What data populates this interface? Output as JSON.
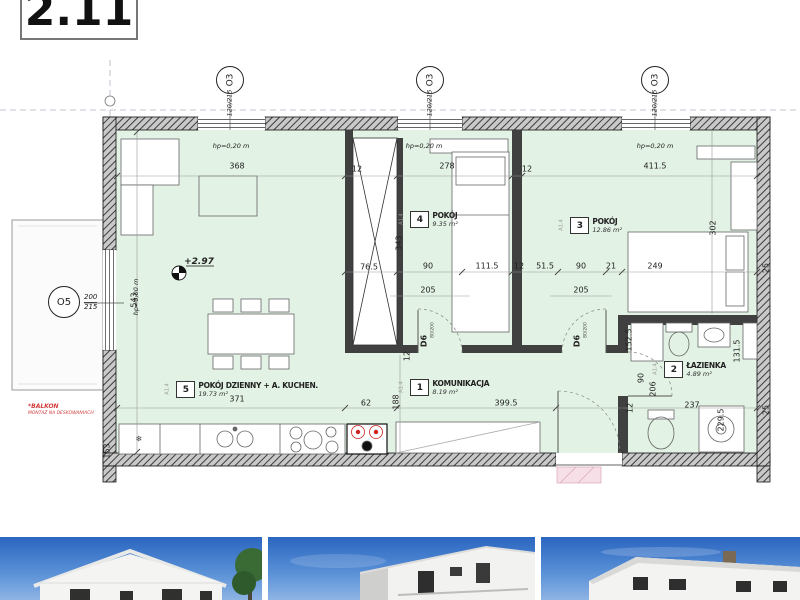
{
  "title_block": {
    "unit_number": "2.11"
  },
  "markers": {
    "top": [
      {
        "label": "O3",
        "size": "120/215"
      },
      {
        "label": "O3",
        "size": "120/215"
      },
      {
        "label": "O3",
        "size": "120/215"
      }
    ],
    "left": {
      "label": "O5",
      "size_top": "200",
      "size_bottom": "215"
    }
  },
  "rooms": [
    {
      "no": "5",
      "name": "POKÓJ DZIENNY + A. KUCHEN.",
      "area": "19.73 m²",
      "ref": "A1.4"
    },
    {
      "no": "4",
      "name": "POKÓJ",
      "area": "9.35 m²",
      "ref": "A1.4"
    },
    {
      "no": "3",
      "name": "POKÓJ",
      "area": "12.86 m²",
      "ref": "A1.4"
    },
    {
      "no": "1",
      "name": "KOMUNIKACJA",
      "area": "8.19 m²",
      "ref": "A1.4"
    },
    {
      "no": "2",
      "name": "ŁAZIENKA",
      "area": "4.89 m²",
      "ref": "A1.4"
    }
  ],
  "doors": [
    {
      "tag": "D6",
      "size": "80/200"
    },
    {
      "tag": "D6",
      "size": "80/200"
    }
  ],
  "annotations": {
    "level_marker": "+2.97",
    "hp_window": "hp=0,20 m",
    "hp_floor": "hp=0,00 m",
    "balcony_note_line1": "*BALKON",
    "balcony_note_line2": "MONTAŻ NA DESKOWANIACH",
    "fridge_icon": "❄"
  },
  "colors": {
    "floor_fill": "#e2f2e4",
    "wall_dark": "#404040",
    "red_accent": "#d23c3c",
    "sky_blue": "#2b66c0"
  },
  "dimensions": [
    {
      "t": "368",
      "x": 237,
      "y": 166
    },
    {
      "t": "278",
      "x": 447,
      "y": 166
    },
    {
      "t": "411.5",
      "x": 655,
      "y": 166
    },
    {
      "t": "12",
      "x": 357,
      "y": 169
    },
    {
      "t": "12",
      "x": 527,
      "y": 169
    },
    {
      "t": "343",
      "x": 399,
      "y": 243,
      "r": true
    },
    {
      "t": "302",
      "x": 713,
      "y": 228,
      "r": true
    },
    {
      "t": "76.5",
      "x": 369,
      "y": 267
    },
    {
      "t": "90",
      "x": 428,
      "y": 266
    },
    {
      "t": "111.5",
      "x": 487,
      "y": 266
    },
    {
      "t": "12",
      "x": 519,
      "y": 266
    },
    {
      "t": "51.5",
      "x": 545,
      "y": 266
    },
    {
      "t": "90",
      "x": 581,
      "y": 266
    },
    {
      "t": "21",
      "x": 611,
      "y": 266
    },
    {
      "t": "249",
      "x": 655,
      "y": 266
    },
    {
      "t": "205",
      "x": 428,
      "y": 290
    },
    {
      "t": "205",
      "x": 581,
      "y": 290
    },
    {
      "t": "25",
      "x": 766,
      "y": 268,
      "r": true
    },
    {
      "t": "543",
      "x": 134,
      "y": 300,
      "r": true
    },
    {
      "t": "371",
      "x": 237,
      "y": 399
    },
    {
      "t": "62",
      "x": 366,
      "y": 403
    },
    {
      "t": "399.5",
      "x": 506,
      "y": 403
    },
    {
      "t": "188",
      "x": 396,
      "y": 402,
      "r": true
    },
    {
      "t": "12",
      "x": 407,
      "y": 356,
      "r": true
    },
    {
      "t": "152.5",
      "x": 629,
      "y": 340,
      "r": true
    },
    {
      "t": "90",
      "x": 641,
      "y": 378,
      "r": true
    },
    {
      "t": "206",
      "x": 653,
      "y": 389,
      "r": true
    },
    {
      "t": "131.5",
      "x": 737,
      "y": 351,
      "r": true
    },
    {
      "t": "229.5",
      "x": 721,
      "y": 420,
      "r": true
    },
    {
      "t": "237",
      "x": 692,
      "y": 405
    },
    {
      "t": "25",
      "x": 766,
      "y": 410,
      "r": true
    },
    {
      "t": "12",
      "x": 630,
      "y": 408,
      "r": true
    },
    {
      "t": "153",
      "x": 107,
      "y": 451,
      "r": true
    }
  ]
}
